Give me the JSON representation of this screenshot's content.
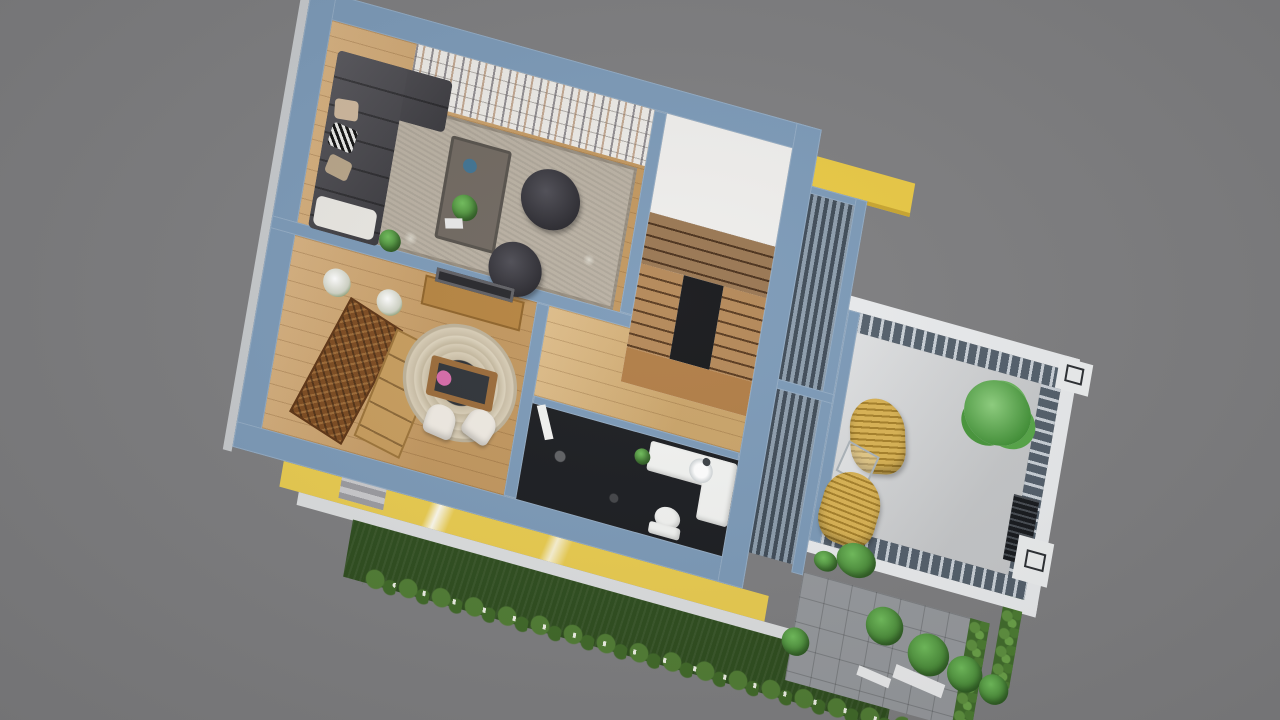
{
  "scene": {
    "type": "architectural-3d-floor-plan-render",
    "description": "Top-down 3D cutaway render of a small house interior with staircase, bathroom and roof terrace, tilted on a plain gray backdrop",
    "background_color": "#7d7d7f",
    "palette": {
      "wall_blue": "#7b99b7",
      "outer_trim": "#c6c9cc",
      "wood_floor": "#cd9f63",
      "hall_wood": "#d6ad6e",
      "stair_wood": "#8a6238",
      "stair_flight_wood": "#a9763f",
      "landing_wood": "#b07c44",
      "stairwell_white": "#efeeec",
      "rug_beige": "#b9b0a2",
      "bookshelf_white": "#eceae6",
      "sofa_charcoal": "#45444a",
      "throw_white": "#e9e7e2",
      "pillow_tan": "#cdb79c",
      "pillow_taupe": "#b7a488",
      "coffee_table": "#6f675f",
      "bowl_blue": "#3f7291",
      "door_brown": "#7c4a1f",
      "sideboard_wood": "#c79c5c",
      "console_wood": "#b5833f",
      "picture_frame": "#26262a",
      "dining_table_wood": "#9a6a38",
      "table_top_dark": "#2e3237",
      "chair_white": "#efeae2",
      "flower_pink": "#d66aa8",
      "bath_floor_dark": "#191b1f",
      "porcelain": "#f2f3f1",
      "beam_yellow": "#e9c843",
      "facade_yellow": "#e9cb4e",
      "walkway_white": "#dcdedf",
      "grass_green": "#2d4c1d",
      "hedge_green": "#3f6a2a",
      "terrace_floor": "#d4d6d8",
      "railing_slate": "#525e6a",
      "parapet_white": "#e9ebed",
      "vent_dark": "#15181c",
      "white_box": "#eceeef",
      "paver_gray": "#95989c",
      "plank_white": "#eaebec",
      "void_dark": "#141518"
    },
    "house": {
      "rooms": [
        {
          "id": "living-room",
          "items": [
            "white bookshelf wall",
            "charcoal sectional sofa",
            "zebra pillow",
            "cream pillows",
            "white throw",
            "striped beige rug",
            "dark coffee table",
            "potted plant",
            "blue bowl",
            "magazine",
            "two round tufted ottomans",
            "oak plank floor"
          ]
        },
        {
          "id": "dining-room",
          "items": [
            "carved dark-wood double door",
            "light wood sideboard",
            "wooden console with framed picture",
            "two white flower arrangements",
            "round braided rug",
            "wood dining table with pink flowers",
            "two white chairs"
          ]
        },
        {
          "id": "stairwell",
          "items": [
            "white cut walls",
            "wooden winder stairs",
            "two flights",
            "mid landing",
            "dark stair void"
          ]
        },
        {
          "id": "hallway",
          "items": [
            "oak plank landing floor",
            "white swing door"
          ]
        },
        {
          "id": "bathroom",
          "items": [
            "dark tile floor",
            "white vanity counter",
            "round sink with faucet",
            "toilet",
            "small green plant",
            "light reflections"
          ]
        }
      ]
    },
    "pergola": {
      "items": [
        "yellow edge beam",
        "blue-gray frame",
        "louvered slat roof",
        "mid divider"
      ]
    },
    "terrace": {
      "items": [
        "white parapet",
        "slotted dark railing",
        "corner post",
        "concrete floor",
        "two yellow wicker lounge chairs",
        "wire side table",
        "palm plant",
        "shrubs",
        "louver vent",
        "white utility box",
        "side hedge"
      ]
    },
    "landscape": {
      "items": [
        "yellow facade band with white streaks",
        "white walkway trim",
        "dark lawn strip",
        "hedge bushes",
        "garden path lights",
        "stone paver patio",
        "corner bushes",
        "white plank steps",
        "entry steps"
      ]
    }
  }
}
